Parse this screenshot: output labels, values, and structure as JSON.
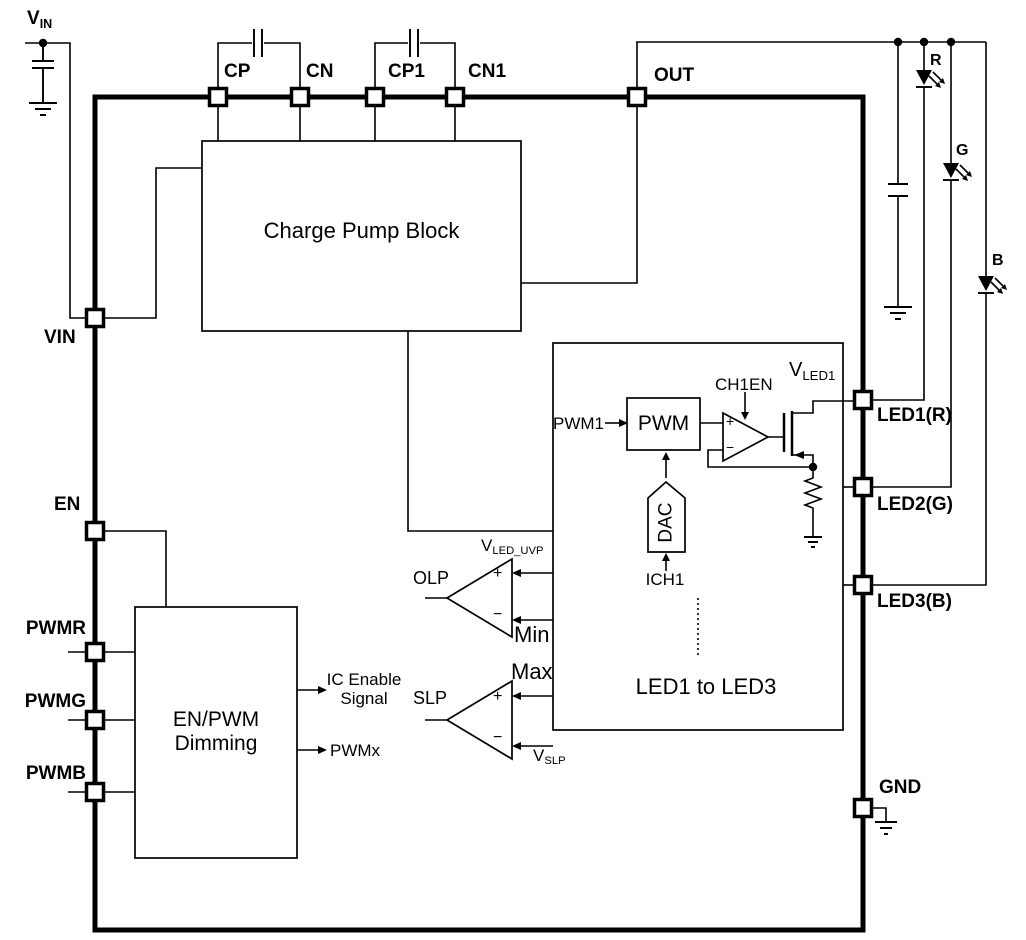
{
  "colors": {
    "line": "#000000",
    "background": "#ffffff"
  },
  "supply": {
    "vin": {
      "main": "V",
      "sub": "IN"
    }
  },
  "pins": {
    "cp": "CP",
    "cn": "CN",
    "cp1": "CP1",
    "cn1": "CN1",
    "out": "OUT",
    "vin": "VIN",
    "en": "EN",
    "pwmr": "PWMR",
    "pwmg": "PWMG",
    "pwmb": "PWMB",
    "led1": "LED1(R)",
    "led2": "LED2(G)",
    "led3": "LED3(B)",
    "gnd": "GND"
  },
  "blocks": {
    "charge_pump": "Charge Pump Block",
    "dimming_line1": "EN/PWM",
    "dimming_line2": "Dimming",
    "led_channels": "LED1 to LED3",
    "pwm": "PWM",
    "dac": "DAC"
  },
  "signals": {
    "pwm1": "PWM1",
    "ch1en": "CH1EN",
    "ich1": "ICH1",
    "vled1": {
      "main": "V",
      "sub": "LED1"
    },
    "ic_enable_line1": "IC Enable",
    "ic_enable_line2": "Signal",
    "pwmx": "PWMx"
  },
  "opamp": {
    "plus": "+",
    "minus": "−"
  },
  "comparators": {
    "olp": {
      "name": "OLP",
      "plus": "+",
      "minus": "−",
      "ref": {
        "main": "V",
        "sub": "LED_UVP"
      },
      "input_label": "Min"
    },
    "slp": {
      "name": "SLP",
      "plus": "+",
      "minus": "−",
      "ref": {
        "main": "V",
        "sub": "SLP"
      },
      "input_label": "Max"
    }
  },
  "leds": {
    "red": "R",
    "green": "G",
    "blue": "B"
  }
}
